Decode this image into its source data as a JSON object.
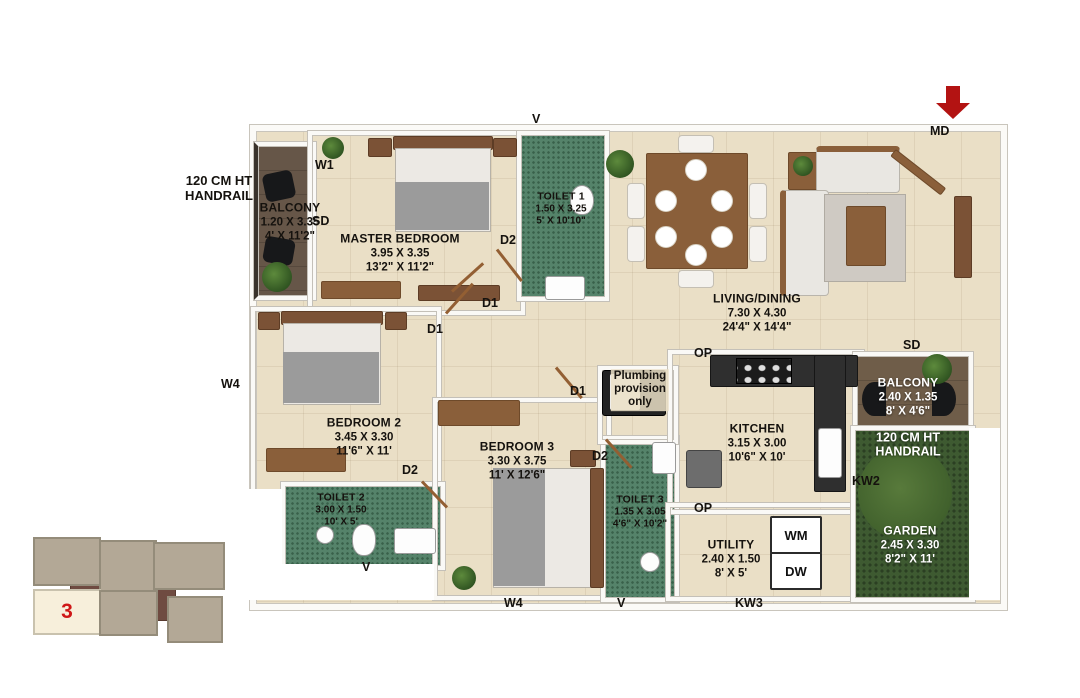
{
  "plan": {
    "rooms": {
      "balcony1": {
        "name": "BALCONY",
        "metric": "1.20 X 3.35",
        "imperial": "4' X 11'2\""
      },
      "master": {
        "name": "MASTER BEDROOM",
        "metric": "3.95 X 3.35",
        "imperial": "13'2\" X 11'2\""
      },
      "toilet1": {
        "name": "TOILET 1",
        "metric": "1.50 X 3.25",
        "imperial": "5' X 10'10\""
      },
      "living": {
        "name": "LIVING/DINING",
        "metric": "7.30 X 4.30",
        "imperial": "24'4\" X 14'4\""
      },
      "balcony2": {
        "name": "BALCONY",
        "metric": "2.40 X 1.35",
        "imperial": "8' X 4'6\""
      },
      "garden": {
        "name": "GARDEN",
        "metric": "2.45 X 3.30",
        "imperial": "8'2\" X 11'"
      },
      "bedroom2": {
        "name": "BEDROOM 2",
        "metric": "3.45 X 3.30",
        "imperial": "11'6\" X 11'"
      },
      "toilet2": {
        "name": "TOILET 2",
        "metric": "3.00 X 1.50",
        "imperial": "10' X 5'"
      },
      "bedroom3": {
        "name": "BEDROOM 3",
        "metric": "3.30 X 3.75",
        "imperial": "11' X 12'6\""
      },
      "toilet3": {
        "name": "TOILET 3",
        "metric": "1.35 X 3.05",
        "imperial": "4'6\" X 10'2\""
      },
      "kitchen": {
        "name": "KITCHEN",
        "metric": "3.15 X 3.00",
        "imperial": "10'6\" X 10'"
      },
      "utility": {
        "name": "UTILITY",
        "metric": "2.40 X 1.50",
        "imperial": "8' X 5'"
      }
    },
    "notes": {
      "handrail_left_line1": "120 CM HT",
      "handrail_left_line2": "HANDRAIL",
      "handrail_garden_line1": "120 CM HT",
      "handrail_garden_line2": "HANDRAIL",
      "plumbing_line1": "Plumbing",
      "plumbing_line2": "provision",
      "plumbing_line3": "only"
    },
    "markers": {
      "w1": "W1",
      "sd_balcony": "SD",
      "v_toilet1": "V",
      "d2_toilet1": "D2",
      "d1_master": "D1",
      "d1_bedroom2": "D1",
      "d1_bedroom3": "D1",
      "d2_toilet2": "D2",
      "d2_toilet3": "D2",
      "v_toilet2": "V",
      "v_toilet3": "V",
      "w4_left": "W4",
      "w4_bottom": "W4",
      "op_kitchen": "OP",
      "op_utility": "OP",
      "kw2": "KW2",
      "kw3": "KW3",
      "sd_living": "SD",
      "md": "MD"
    },
    "appliances": {
      "wm": "WM",
      "dw": "DW"
    }
  },
  "keyplan": {
    "unit_number": "3"
  },
  "colors": {
    "floor": "#eadfc6",
    "toilet_floor": "#55836a",
    "garden": "#3e5a31",
    "balcony_floor": "#665648",
    "wall": "#fbfaf7",
    "accent_red": "#b31312",
    "keyplan_block": "#b3a896",
    "keyplan_corridor": "#6f4b41",
    "unit_number_red": "#cf1717"
  }
}
